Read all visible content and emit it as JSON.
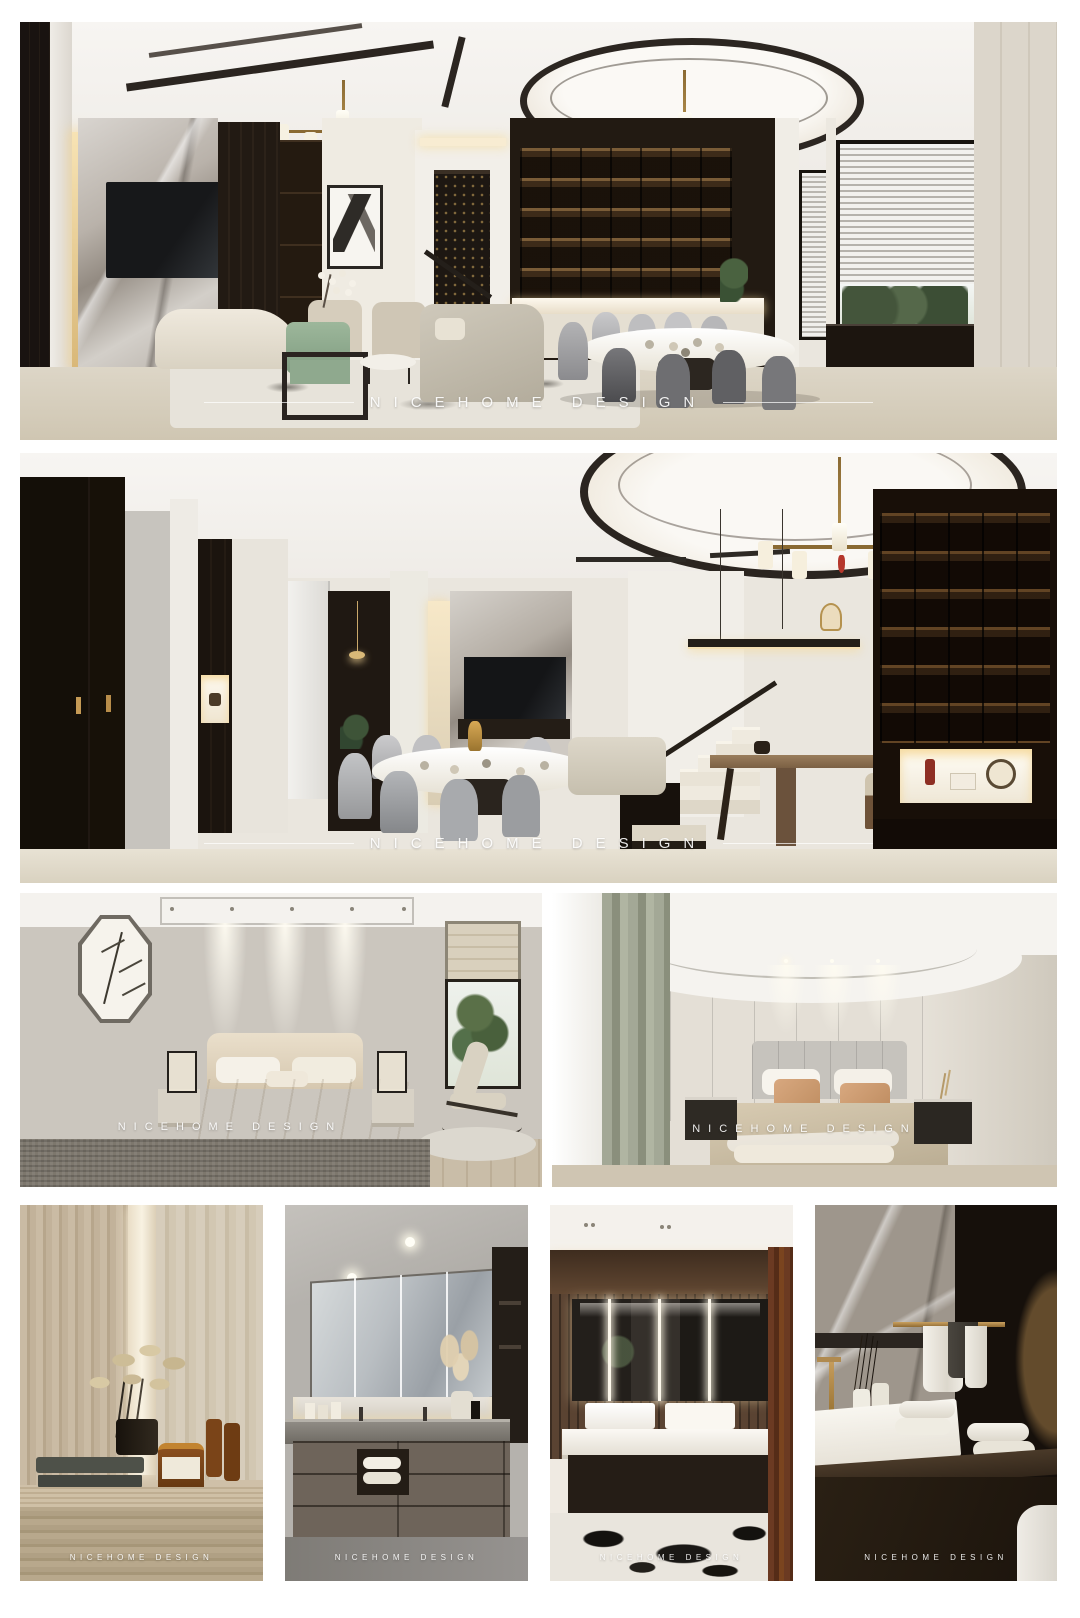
{
  "brand": {
    "name": "NICEHOME DESIGN"
  },
  "watermark": {
    "text": "NICEHOME DESIGN"
  },
  "photos": [
    {
      "id": "living-dining-room",
      "alt": "living room with marble TV wall, green armchair, chandeliers and dining area with grey chairs and blinds"
    },
    {
      "id": "dining-stair-hall",
      "alt": "dining room with round table, black entry doors, staircase, tea table and dark display shelving wall"
    },
    {
      "id": "bedroom-neutral",
      "alt": "beige bedroom with octagonal bamboo artwork, spotlights, bed and rocking chair by window"
    },
    {
      "id": "bedroom-sage",
      "alt": "bedroom with sage curtains, olive wall panels, white and salmon pillows"
    },
    {
      "id": "travertine-vanity-detail",
      "alt": "travertine counter with dried plant, amber jars and folded towels"
    },
    {
      "id": "bathroom-vanity",
      "alt": "bathroom vanity with long mirror cabinets and taupe drawers"
    },
    {
      "id": "bathroom-double-sink",
      "alt": "double sink bathroom with backlit mirrors, wood wall and veined marble floor"
    },
    {
      "id": "bathroom-towel-detail",
      "alt": "marble wall with brass towel rail, white sink, gold faucet and rolled towels"
    }
  ],
  "palette": {
    "page_bg": "#ffffff",
    "dark_wood": "#1b140e",
    "cream_wall": "#efebe2",
    "ceiling_white": "#f6f4f1",
    "marble_grey": "#b9b2aa",
    "floor_beige": "#d9d2c0",
    "accent_green_chair": "#8fa98e",
    "accent_brass": "#b5924f",
    "shelf_glow": "#f4d9a8",
    "dining_chair_grey": "#9a9a9c",
    "bedding_beige": "#cfc0a6",
    "sage_curtain": "#9aa08f",
    "olive_panel": "#a8a28b",
    "salmon_pillow": "#cf9d7c",
    "travertine": "#c8b89f",
    "towel_sage": "#4e5149",
    "rust_curtain": "#6b3a22",
    "watermark_white": "#ffffff"
  }
}
